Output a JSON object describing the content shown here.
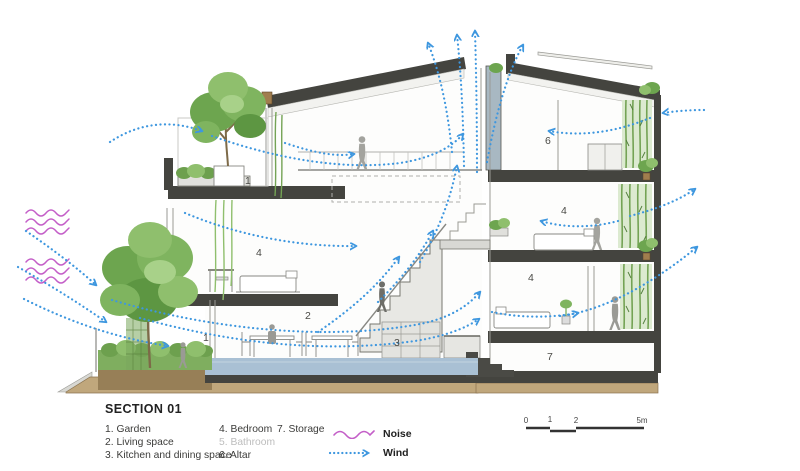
{
  "title": "SECTION 01",
  "legend": {
    "col1": [
      "1. Garden",
      "2. Living space",
      "3. Kitchen and dining space"
    ],
    "col2": [
      "4. Bedroom",
      "5. Bathroom",
      "6. Altar"
    ],
    "col3": [
      "7. Storage"
    ],
    "noise_label": "Noise",
    "wind_label": "Wind"
  },
  "scale_bar": {
    "t0": "0",
    "t1": "1",
    "t2": "2",
    "t3": "5m"
  },
  "room_labels": [
    {
      "num": "1",
      "room": "garden-terrace"
    },
    {
      "num": "1",
      "room": "garden-ground"
    },
    {
      "num": "2",
      "room": "living-space"
    },
    {
      "num": "3",
      "room": "kitchen-dining"
    },
    {
      "num": "4",
      "room": "bedroom-left"
    },
    {
      "num": "4",
      "room": "bedroom-tower-upper"
    },
    {
      "num": "4",
      "room": "bedroom-tower-lower"
    },
    {
      "num": "6",
      "room": "altar"
    },
    {
      "num": "7",
      "room": "storage"
    }
  ],
  "colors": {
    "wind": "#3e97df",
    "noise": "#c45fc8",
    "structure": "#44443f",
    "greenery": "#6fa452",
    "ground": "#c0a77c",
    "paving": "#a9c0d4"
  }
}
